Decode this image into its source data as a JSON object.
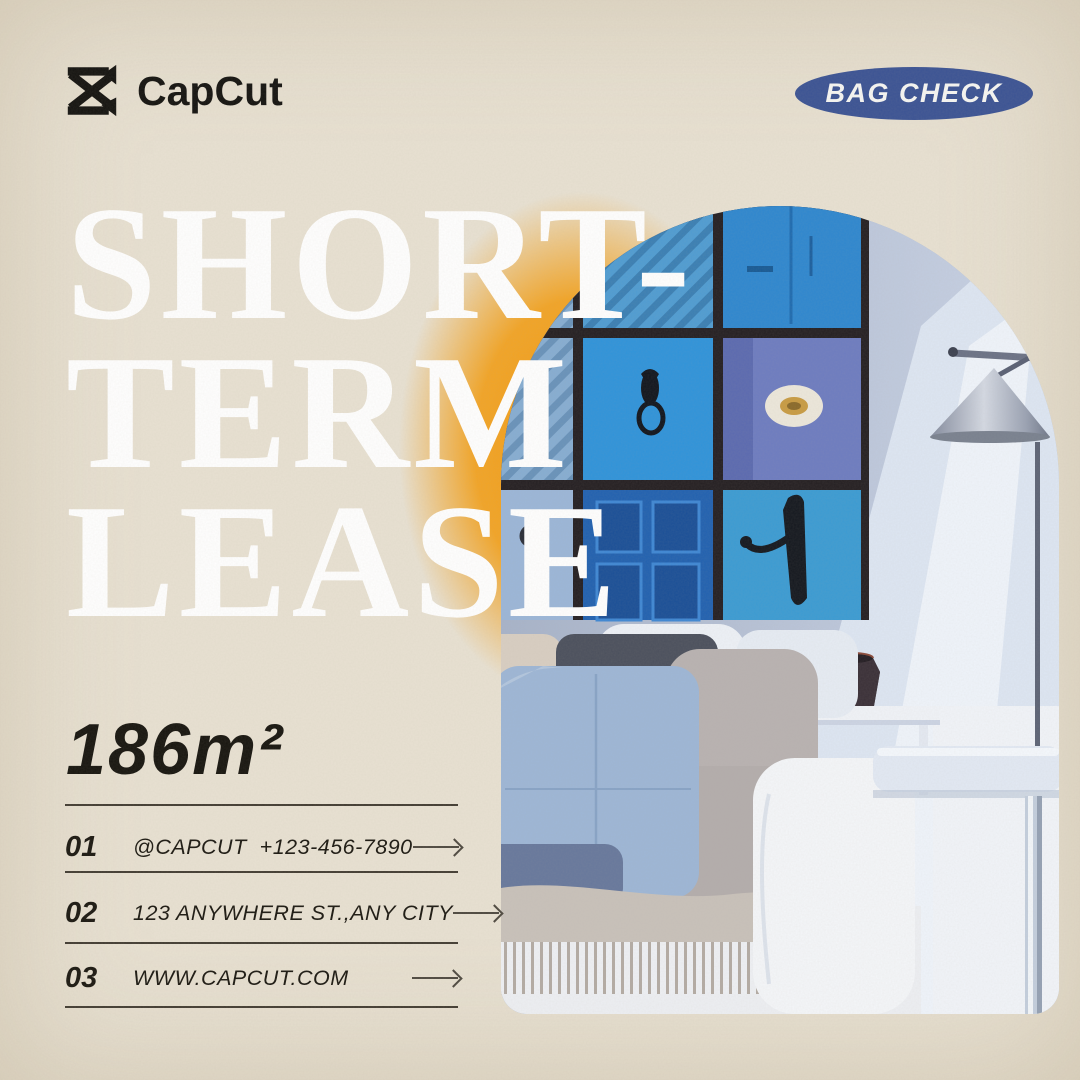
{
  "page": {
    "background_color": "#e8e1d2",
    "accent_orange": "#f4a11b",
    "badge_blue": "#3b5394",
    "text_color": "#1b1811"
  },
  "header": {
    "logo": {
      "icon": "capcut-logo-icon",
      "text": "CapCut"
    },
    "badge": {
      "label": "BAG CHECK"
    }
  },
  "hero": {
    "title_line1": "SHORT-",
    "title_line2": "TERM",
    "title_line3": "LEASE",
    "photo": "arched-living-room-photo-with-blue-door-gallery-wall"
  },
  "details": {
    "area": "186m²",
    "rows": [
      {
        "number": "01",
        "label": "@CAPCUT  +123-456-7890",
        "icon": "long-arrow-right-icon"
      },
      {
        "number": "02",
        "label": "123 ANYWHERE ST.,ANY CITY",
        "icon": "long-arrow-right-icon"
      },
      {
        "number": "03",
        "label": "WWW.CAPCUT.COM",
        "icon": "long-arrow-right-icon"
      }
    ]
  }
}
